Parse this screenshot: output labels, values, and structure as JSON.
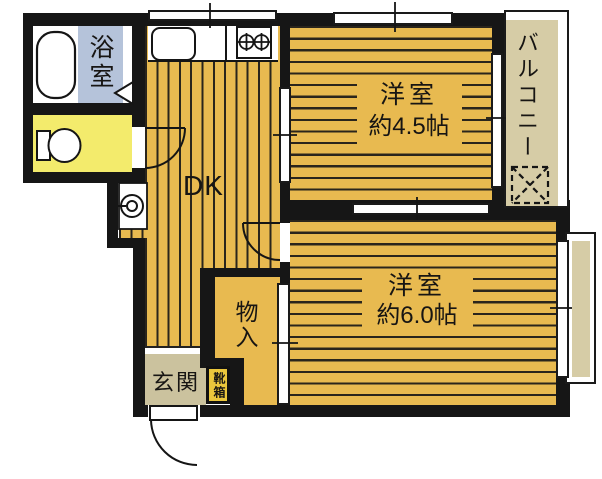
{
  "floorplan": {
    "labels": {
      "bathroom": "浴室",
      "dining_kitchen": "DK",
      "room_45": {
        "name": "洋室",
        "size": "約4.5帖"
      },
      "room_60": {
        "name": "洋室",
        "size": "約6.0帖"
      },
      "balcony": "バルコニー",
      "storage": "物入",
      "entrance": "玄関",
      "shoe_box": "靴箱"
    },
    "colors": {
      "wall": "#161616",
      "wood_floor": "#E8BA50",
      "plank_line": "#2A251C",
      "bathroom_floor": "#B5C3DA",
      "toilet_floor": "#F3EB6C",
      "entrance_floor": "#CBC29E",
      "balcony_floor": "#D6CCA6",
      "shoe_box_fill": "#EAC63C"
    },
    "icons": {
      "bathtub": "rounded-rect outline",
      "toilet": "tank and bowl outline",
      "kitchen_sink": "rounded-rect outline",
      "gas_stove": "two crossed burner circles",
      "washing_machine": "circle in pan",
      "drying_area": "dashed box with X",
      "doors": "quarter-circle swing arcs",
      "bath_door": "triangle marker"
    }
  }
}
